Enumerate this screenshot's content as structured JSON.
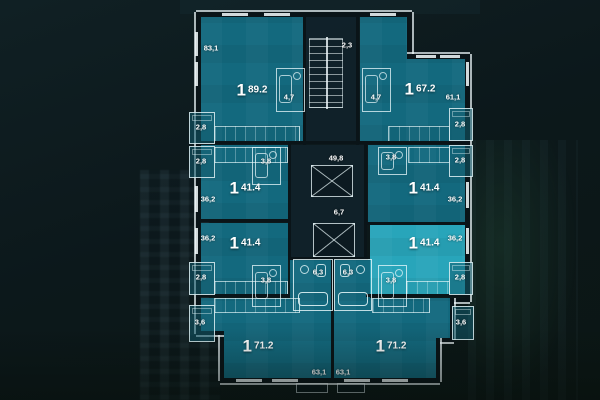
{
  "colors": {
    "background": "#0c181b",
    "apartment_fill": "#146E84",
    "apartment_selected": "#29AAC0",
    "core_fill": "#11222A",
    "label_text": "#FFFFFF"
  },
  "core": {
    "stairwell_area": "2,3",
    "corridor_area": "49,8",
    "hall_area": "6,7"
  },
  "apartments": [
    {
      "rooms": "1",
      "total": "89.2",
      "living": "83,1",
      "bath": "4,7",
      "balcony": "2,8",
      "highlighted": false
    },
    {
      "rooms": "1",
      "total": "67.2",
      "living": "61,1",
      "bath": "4,7",
      "balcony": "2,8",
      "highlighted": false
    },
    {
      "rooms": "1",
      "total": "41.4",
      "living": "36,2",
      "bath": "3,8",
      "balcony": "2,8",
      "highlighted": false
    },
    {
      "rooms": "1",
      "total": "41.4",
      "living": "36,2",
      "bath": "3,8",
      "balcony": "2,8",
      "highlighted": false
    },
    {
      "rooms": "1",
      "total": "41.4",
      "living": "36,2",
      "bath": "3,8",
      "balcony": "2,8",
      "highlighted": false
    },
    {
      "rooms": "1",
      "total": "41.4",
      "living": "36,2",
      "bath": "3,8",
      "balcony": "2,8",
      "highlighted": true
    },
    {
      "rooms": "1",
      "total": "71.2",
      "living": "63,1",
      "bath": "6,3",
      "balcony": "3,6",
      "highlighted": false
    },
    {
      "rooms": "1",
      "total": "71.2",
      "living": "63,1",
      "bath": "6,3",
      "balcony": "3,6",
      "highlighted": false
    }
  ]
}
